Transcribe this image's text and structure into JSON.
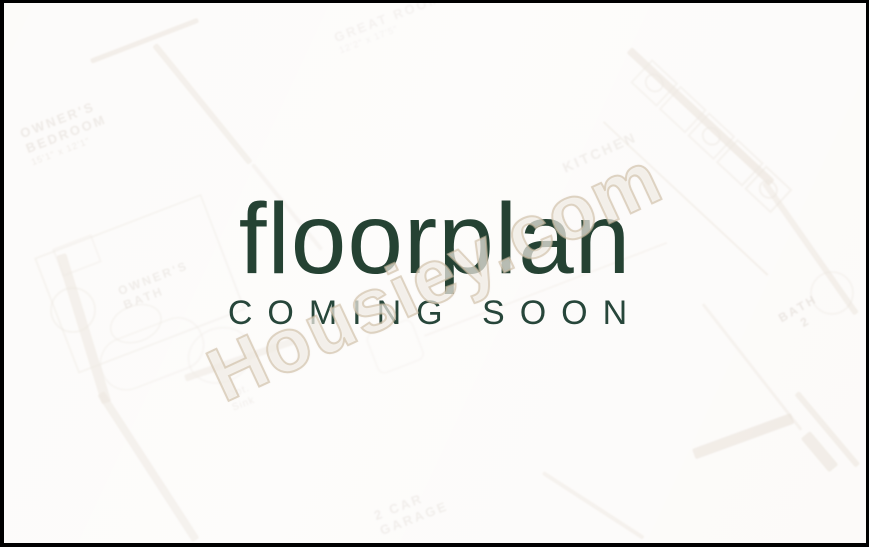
{
  "window": {
    "frame_color": "#000000",
    "canvas_color": "#fbf9f7"
  },
  "overlay": {
    "title": "floorplan",
    "subtitle": "COMING SOON",
    "text_color": "#254233",
    "watermark": {
      "text": "Housiey.com",
      "color": "#cdbda4"
    }
  },
  "floorplan": {
    "wall_color": "#c9b7a2",
    "label_color": "#ab9c8d",
    "labels": [
      {
        "name": "great-room",
        "lines": [
          "GREAT ROOM",
          "12'2\" x 17'5\""
        ]
      },
      {
        "name": "owners-bedroom",
        "lines": [
          "OWNER'S",
          "BEDROOM",
          "15'1\" x 12'1\""
        ]
      },
      {
        "name": "kitchen",
        "lines": [
          "KITCHEN"
        ]
      },
      {
        "name": "owners-bath",
        "lines": [
          "OWNER'S",
          "BATH"
        ]
      },
      {
        "name": "bath-2",
        "lines": [
          "BATH",
          "2"
        ]
      },
      {
        "name": "opt-sink",
        "lines": [
          "Opt.",
          "Sink"
        ]
      },
      {
        "name": "garage",
        "lines": [
          "2 CAR",
          "GARAGE"
        ]
      }
    ]
  }
}
